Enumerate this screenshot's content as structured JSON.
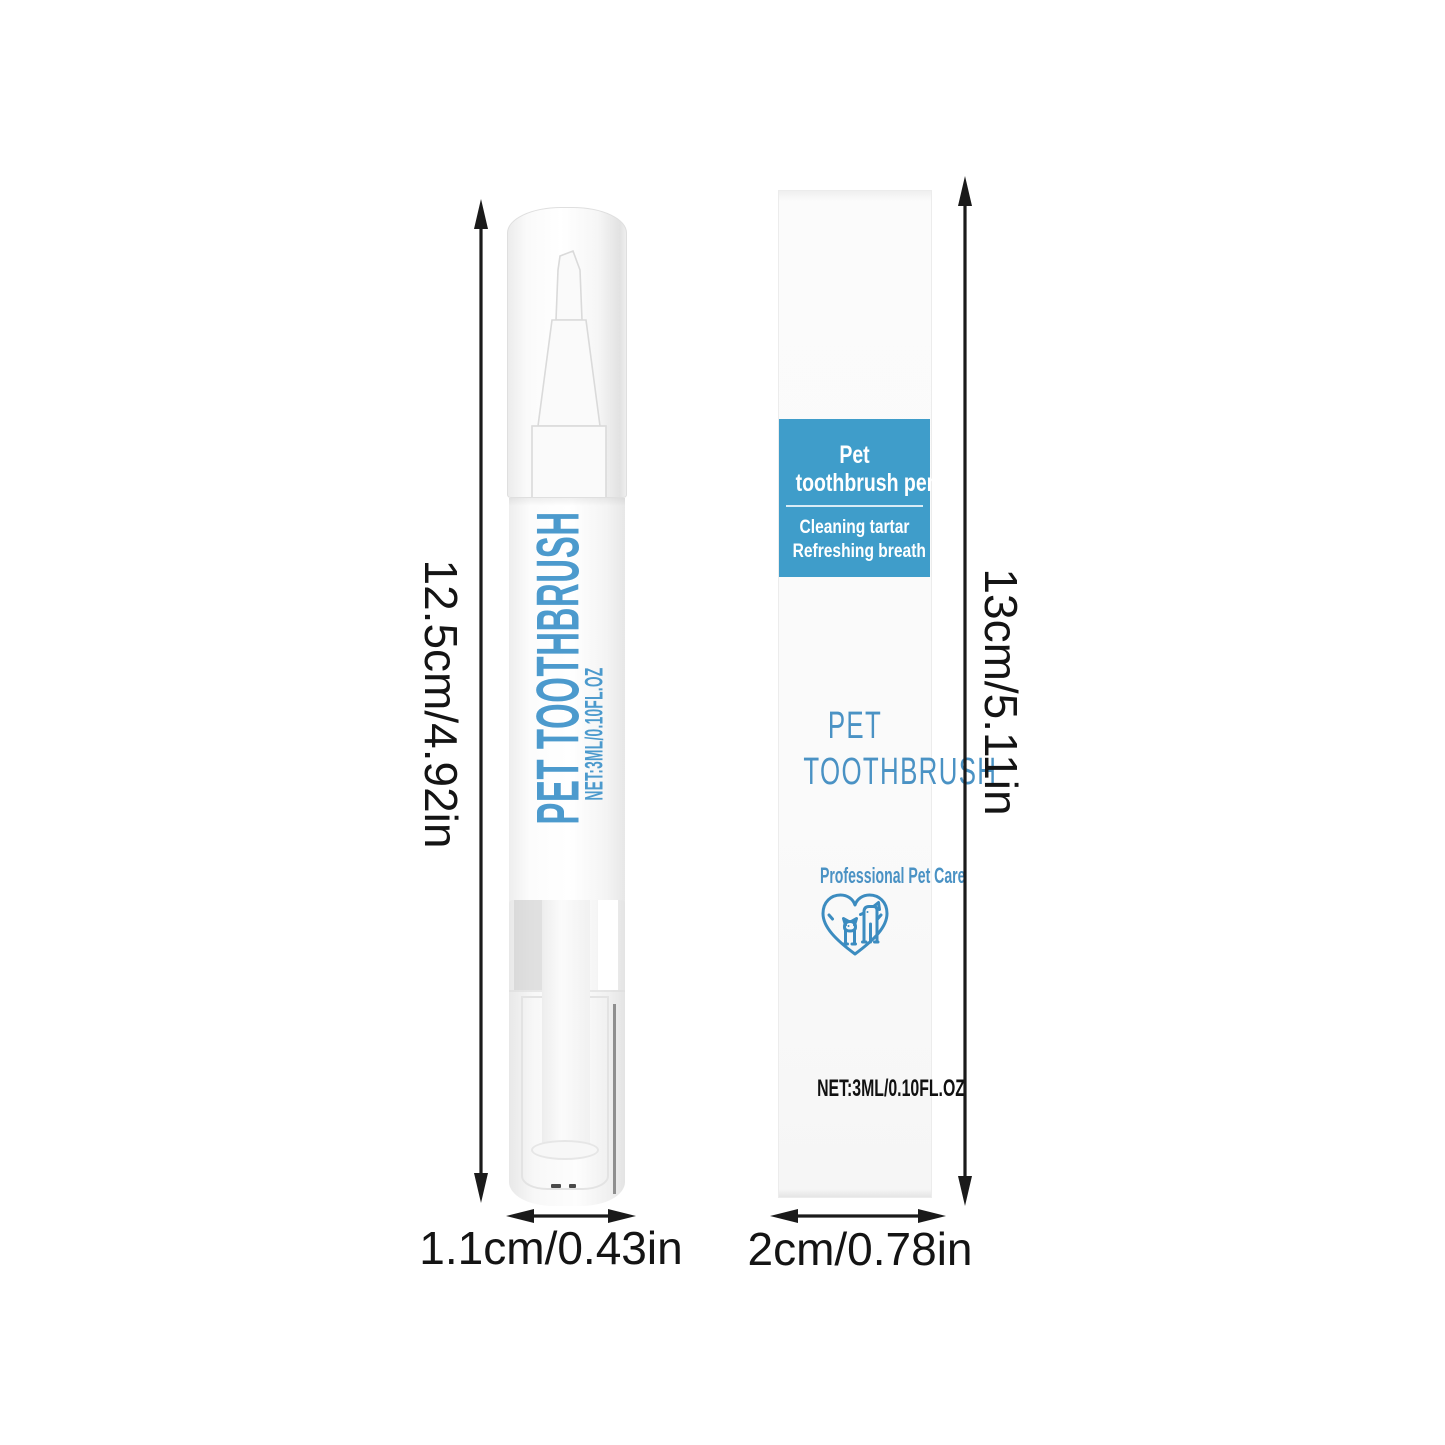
{
  "colors": {
    "panel_blue": "#3f9dca",
    "box_text_blue": "#4a92c4",
    "pen_text_blue": "#4c9acd",
    "heart_blue": "#3c8cc0",
    "dimension_text": "#141414"
  },
  "pen": {
    "body_text": "PET TOOTHBRUSH",
    "body_net_text": "NET:3ML/0.10FL.OZ",
    "height_label": "12.5cm/4.92in",
    "width_label": "1.1cm/0.43in"
  },
  "box": {
    "panel": {
      "title_line1": "Pet",
      "title_line2": "toothbrush pen",
      "subtitle_line1": "Cleaning tartar",
      "subtitle_line2": "Refreshing breath"
    },
    "name_line1": "PET",
    "name_line2": "TOOTHBRUSH",
    "tagline": "Professional Pet Care",
    "net_text": "NET:3ML/0.10FL.OZ",
    "height_label": "13cm/5.11in",
    "width_label": "2cm/0.78in"
  },
  "icons": {
    "heart_pets": "heart-with-dog-and-cat"
  }
}
